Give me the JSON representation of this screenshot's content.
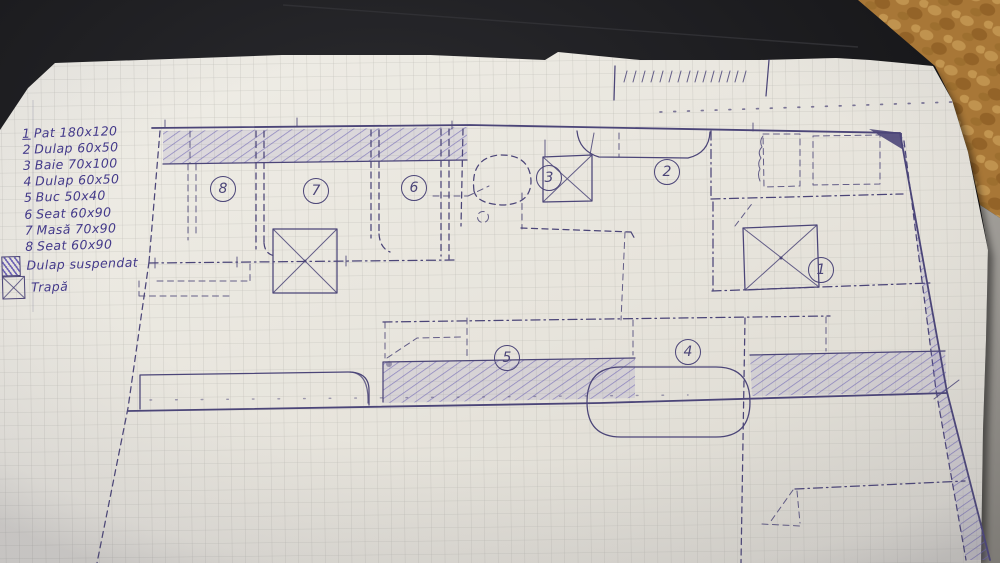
{
  "legend": {
    "items": [
      {
        "num": "1",
        "label": "Pat 180x120"
      },
      {
        "num": "2",
        "label": "Dulap 60x50"
      },
      {
        "num": "3",
        "label": "Baie 70x100"
      },
      {
        "num": "4",
        "label": "Dulap 60x50"
      },
      {
        "num": "5",
        "label": "Buc 50x40"
      },
      {
        "num": "6",
        "label": "Seat 60x90"
      },
      {
        "num": "7",
        "label": "Masă 70x90"
      },
      {
        "num": "8",
        "label": "Seat 60x90"
      }
    ],
    "symbols": [
      {
        "icon": "hatched-square",
        "label": "Dulap suspendat"
      },
      {
        "icon": "x-square",
        "label": "Trapă"
      }
    ]
  },
  "plan": {
    "markers": [
      {
        "num": "1",
        "x": 821,
        "y": 270
      },
      {
        "num": "2",
        "x": 667,
        "y": 172
      },
      {
        "num": "3",
        "x": 549,
        "y": 178
      },
      {
        "num": "4",
        "x": 688,
        "y": 352
      },
      {
        "num": "5",
        "x": 507,
        "y": 358
      },
      {
        "num": "6",
        "x": 414,
        "y": 188
      },
      {
        "num": "7",
        "x": 316,
        "y": 191
      },
      {
        "num": "8",
        "x": 223,
        "y": 189
      }
    ]
  },
  "colors": {
    "ink": "#4b4578",
    "legend-ink": "#43398a",
    "hatch": "#6b61b4",
    "grid": "#b3b2ac",
    "paper": "#e9e6de",
    "table": "#17171a",
    "fabric": "#b07b3a",
    "floor": "#8f8c86"
  }
}
